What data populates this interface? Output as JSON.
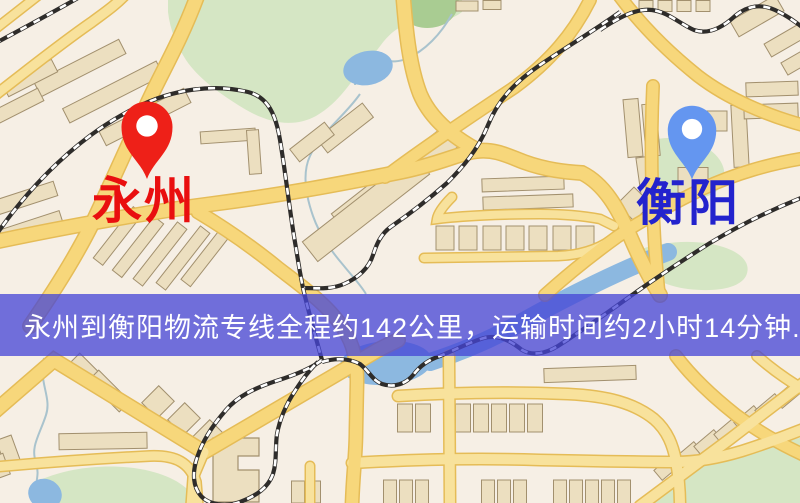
{
  "banner": {
    "text": "永州到衡阳物流专线全程约142公里，运输时间约2小时14分钟.",
    "bg": "rgba(70,70,214,0.76)",
    "text_color": "#ffffff",
    "top": 294,
    "height": 62
  },
  "route": {
    "from_city": "永州",
    "to_city": "衡阳",
    "distance_text": "约142公里",
    "duration_text": "约2小时14分钟"
  },
  "markers": [
    {
      "name": "yongzhou",
      "label": "永州",
      "pin_color": "#ee2018",
      "label_color": "#e90f0f",
      "x": 147,
      "y": 128,
      "scale": 1.02,
      "label_x": 92,
      "label_y": 176
    },
    {
      "name": "hengyang",
      "label": "衡阳",
      "pin_color": "#6496f0",
      "label_color": "#2323cd",
      "x": 692,
      "y": 131,
      "scale": 0.97,
      "label_x": 636,
      "label_y": 178
    }
  ],
  "map": {
    "bg": "#f6efe5",
    "palette": {
      "green": "#d5e6c4",
      "green_dark": "#a9cc92",
      "water": "#8cb8e0",
      "stream": "#a9c3cd",
      "building": "#ecdfc0",
      "building_line": "#a2906e",
      "road_casing": "#e5bc57",
      "road_fill": "#f7d77b",
      "road_minor": "#f8e29c",
      "rail_dark": "#2e2c2a"
    },
    "greens": [
      "M168,-6 L462,-6 L462,12 C444,26 428,18 408,24 C388,30 380,48 366,64 C350,82 340,102 316,116 C292,129 266,122 243,108 C220,94 198,78 186,60 C177,46 170,30 168,12 Z",
      "M646,142 C668,134 694,138 710,150 C726,162 728,177 719,189 C708,200 688,201 670,195 C653,189 644,176 644,161 Z",
      "M633,252 C658,242 690,239 716,245 C741,251 752,263 746,276 C739,289 714,292 688,289 C663,286 643,274 633,262 Z",
      "M40,480 C68,468 102,464 134,468 C163,472 182,482 192,494 L194,506 L36,506 Z",
      "M636,506 C658,486 688,468 720,460 C752,452 778,444 806,436 L806,506 Z"
    ],
    "park_pond": "M404,-6 L458,-6 C460,4 458,14 448,22 C436,30 418,30 408,22 C402,16 402,6 404,-6 Z",
    "streams": [
      "M452,14 C441,34 425,51 406,59 C391,65 379,57 367,63 C359,68 355,77 355,85",
      "M360,94 C344,117 320,133 310,156 C302,173 306,196 313,216 C320,236 332,252 344,266 C352,276 360,284 366,294",
      "M44,358 C38,382 52,397 46,415 C40,434 30,447 36,462 C40,475 35,484 35,494"
    ],
    "river": "M668,252 C625,268 568,296 522,322 C492,339 458,353 430,362",
    "waters": [
      {
        "cx": 368,
        "cy": 68,
        "rx": 25,
        "ry": 17,
        "r": -12
      },
      {
        "cx": 386,
        "cy": 363,
        "rx": 46,
        "ry": 22,
        "r": -4
      },
      {
        "cx": 45,
        "cy": 494,
        "rx": 17,
        "ry": 15,
        "r": 20
      }
    ],
    "roads": [
      {
        "d": "M198,-6 C182,38 162,72 149,100 C132,136 112,182 92,224 C72,264 48,300 30,326",
        "w": 13
      },
      {
        "d": "M-6,412 L54,360 L204,452 L378,350 L398,340",
        "w": 13
      },
      {
        "d": "M204,452 L193,478 L191,506",
        "w": 9,
        "minor": true
      },
      {
        "d": "M-6,242 C70,226 150,212 212,204 C282,195 340,184 400,172 C440,164 462,152 477,151 C496,149 508,156 524,162 C546,170 566,172 582,173 C604,184 618,208 630,236 C642,264 652,282 660,295",
        "w": 13
      },
      {
        "d": "M403,-6 C406,34 410,68 420,94 C431,120 455,138 477,150",
        "w": 13
      },
      {
        "d": "M385,177 C422,149 470,117 515,87 C550,61 573,34 590,0",
        "w": 11
      },
      {
        "d": "M653,86 C651,130 651,180 654,230 C655,252 657,275 659,295",
        "w": 11
      },
      {
        "d": "M618,-6 C640,24 668,52 698,76 C728,99 768,116 806,126",
        "w": 11
      },
      {
        "d": "M-6,96 C28,70 60,44 92,22 C104,13 116,5 126,-6",
        "w": 9,
        "minor": true
      },
      {
        "d": "M-6,30 L40,-6",
        "w": 8,
        "minor": true
      },
      {
        "d": "M452,197 C443,206 438,213 437,219 C460,216 500,214 540,214 C566,214 584,216 600,219 L614,226",
        "w": 8,
        "minor": true
      },
      {
        "d": "M424,258 L558,256 C582,255 598,249 611,240",
        "w": 8,
        "minor": true
      },
      {
        "d": "M545,295 C566,276 592,255 617,237 C642,220 672,204 702,189 C734,174 772,163 806,158",
        "w": 11
      },
      {
        "d": "M676,356 C691,376 712,396 736,415 C760,433 786,447 806,456",
        "w": 11
      },
      {
        "d": "M757,356 C773,370 792,383 806,391",
        "w": 9,
        "minor": true
      },
      {
        "d": "M640,506 C670,484 700,461 730,439 C756,419 782,399 806,381",
        "w": 10,
        "minor": true
      },
      {
        "d": "M449,356 L450,506",
        "w": 10,
        "minor": true
      },
      {
        "d": "M398,396 C460,392 520,392 568,394 C608,396 634,403 654,419 C668,431 673,446 676,461 C679,478 680,492 680,506",
        "w": 10,
        "minor": true
      },
      {
        "d": "M352,463 C420,459 480,458 540,460 C590,461 640,462 676,462 C700,462 722,457 742,451 C764,444 786,436 806,428",
        "w": 10,
        "minor": true
      },
      {
        "d": "M198,212 C228,230 256,250 278,268 C300,285 330,306 344,330 C354,345 357,362 357,382 L356,430 C356,456 353,472 352,506",
        "w": 12
      },
      {
        "d": "M310,466 L310,506",
        "w": 8,
        "minor": true
      },
      {
        "d": "M-6,467 C50,462 110,458 150,456 C176,455 190,463 196,482 L198,506",
        "w": 9,
        "minor": true
      }
    ],
    "rails": [
      "M-6,44 C20,30 50,14 85,-6",
      "M-6,238 C30,185 80,135 135,108 C175,88 215,84 248,92 C268,97 276,115 280,140 C286,175 290,215 296,248 C299,268 301,278 303,288",
      "M620,12 C595,30 565,48 540,65 C515,82 498,100 488,125 C478,150 462,168 447,183 C430,198 408,215 392,226 C380,234 376,246 373,255 C369,268 358,278 344,284 C330,290 315,288 304,288",
      "M303,288 C308,310 315,335 322,360",
      "M322,360 C312,368 295,375 276,381 C255,388 238,396 226,410 C212,426 202,442 197,458 C192,473 193,487 201,496 C209,505 226,507 240,502 C256,496 268,488 273,474 C277,461 275,448 277,434 C280,418 287,403 295,391 C302,380 310,369 318,362",
      "M322,362 C335,358 348,358 360,364 C370,372 372,380 382,384 C394,388 406,384 414,374 C420,366 428,360 440,356 C455,350 470,342 484,338 C500,334 512,342 522,350 C532,356 545,354 558,346 C575,335 600,318 625,300 C650,282 680,262 710,243 C740,225 770,210 806,196",
      "M600,30 C618,18 636,8 652,10 C668,12 680,24 694,30 C708,35 722,28 735,16 C748,5 762,4 775,10 C788,16 798,24 806,30"
    ],
    "buildings": [
      {
        "cx": 80,
        "cy": 68,
        "w": 95,
        "h": 16,
        "r": -27
      },
      {
        "cx": 113,
        "cy": 92,
        "w": 105,
        "h": 16,
        "r": -27
      },
      {
        "cx": 145,
        "cy": 117,
        "w": 95,
        "h": 16,
        "r": -27
      },
      {
        "cx": 30,
        "cy": 78,
        "w": 55,
        "h": 14,
        "r": -27
      },
      {
        "cx": 14,
        "cy": 108,
        "w": 60,
        "h": 14,
        "r": -27
      },
      {
        "cx": 26,
        "cy": 198,
        "w": 62,
        "h": 15,
        "r": -18
      },
      {
        "cx": 30,
        "cy": 228,
        "w": 66,
        "h": 15,
        "r": -18
      },
      {
        "cx": 228,
        "cy": 136,
        "w": 55,
        "h": 12,
        "r": -4
      },
      {
        "cx": 254,
        "cy": 152,
        "w": 12,
        "h": 44,
        "r": -4
      },
      {
        "cx": 118,
        "cy": 236,
        "w": 65,
        "h": 12,
        "r": -52
      },
      {
        "cx": 138,
        "cy": 247,
        "w": 68,
        "h": 12,
        "r": -52
      },
      {
        "cx": 160,
        "cy": 254,
        "w": 72,
        "h": 12,
        "r": -52
      },
      {
        "cx": 183,
        "cy": 258,
        "w": 72,
        "h": 12,
        "r": -52
      },
      {
        "cx": 206,
        "cy": 257,
        "w": 66,
        "h": 12,
        "r": -52
      },
      {
        "cx": 395,
        "cy": 180,
        "w": 142,
        "h": 25,
        "r": -38
      },
      {
        "cx": 366,
        "cy": 208,
        "w": 142,
        "h": 25,
        "r": -38
      },
      {
        "cx": 345,
        "cy": 128,
        "w": 58,
        "h": 18,
        "r": -38
      },
      {
        "cx": 312,
        "cy": 142,
        "w": 44,
        "h": 16,
        "r": -38
      },
      {
        "cx": 523,
        "cy": 184,
        "w": 82,
        "h": 13,
        "r": -2
      },
      {
        "cx": 528,
        "cy": 202,
        "w": 90,
        "h": 13,
        "r": -2
      },
      {
        "cx": 445,
        "cy": 238,
        "w": 18,
        "h": 24,
        "r": 0
      },
      {
        "cx": 468,
        "cy": 238,
        "w": 18,
        "h": 24,
        "r": 0
      },
      {
        "cx": 492,
        "cy": 238,
        "w": 18,
        "h": 24,
        "r": 0
      },
      {
        "cx": 515,
        "cy": 238,
        "w": 18,
        "h": 24,
        "r": 0
      },
      {
        "cx": 538,
        "cy": 238,
        "w": 18,
        "h": 24,
        "r": 0
      },
      {
        "cx": 562,
        "cy": 238,
        "w": 18,
        "h": 24,
        "r": 0
      },
      {
        "cx": 585,
        "cy": 238,
        "w": 18,
        "h": 24,
        "r": 0
      },
      {
        "cx": 633,
        "cy": 128,
        "w": 15,
        "h": 58,
        "r": -5
      },
      {
        "cx": 651,
        "cy": 130,
        "w": 14,
        "h": 52,
        "r": -5
      },
      {
        "cx": 716,
        "cy": 121,
        "w": 22,
        "h": 20,
        "r": 0
      },
      {
        "cx": 693,
        "cy": 180,
        "w": 30,
        "h": 25,
        "r": 0
      },
      {
        "cx": 740,
        "cy": 136,
        "w": 15,
        "h": 62,
        "r": -3
      },
      {
        "cx": 645,
        "cy": 176,
        "w": 13,
        "h": 38,
        "r": -8
      },
      {
        "cx": 634,
        "cy": 204,
        "w": 24,
        "h": 24,
        "r": 45
      },
      {
        "cx": 772,
        "cy": 89,
        "w": 52,
        "h": 14,
        "r": -2
      },
      {
        "cx": 771,
        "cy": 111,
        "w": 54,
        "h": 14,
        "r": -2
      },
      {
        "cx": 646,
        "cy": 6,
        "w": 14,
        "h": 11,
        "r": 0
      },
      {
        "cx": 665,
        "cy": 6,
        "w": 14,
        "h": 11,
        "r": 0
      },
      {
        "cx": 684,
        "cy": 6,
        "w": 14,
        "h": 11,
        "r": 0
      },
      {
        "cx": 703,
        "cy": 6,
        "w": 14,
        "h": 11,
        "r": 0
      },
      {
        "cx": 757,
        "cy": 16,
        "w": 52,
        "h": 18,
        "r": -30
      },
      {
        "cx": 786,
        "cy": 40,
        "w": 42,
        "h": 15,
        "r": -30
      },
      {
        "cx": 800,
        "cy": 60,
        "w": 36,
        "h": 14,
        "r": -30
      },
      {
        "cx": 467,
        "cy": 6,
        "w": 22,
        "h": 10,
        "r": 0
      },
      {
        "cx": 492,
        "cy": 5,
        "w": 18,
        "h": 9,
        "r": 0
      },
      {
        "cx": 90,
        "cy": 374,
        "w": 44,
        "h": 15,
        "r": 45
      },
      {
        "cx": 109,
        "cy": 391,
        "w": 44,
        "h": 15,
        "r": 45
      },
      {
        "cx": 158,
        "cy": 402,
        "w": 22,
        "h": 24,
        "r": 45
      },
      {
        "cx": 184,
        "cy": 419,
        "w": 22,
        "h": 24,
        "r": 45
      },
      {
        "cx": 209,
        "cy": 436,
        "w": 22,
        "h": 24,
        "r": 45
      },
      {
        "cx": 103,
        "cy": 441,
        "w": 88,
        "h": 16,
        "r": -1
      },
      {
        "cx": 8,
        "cy": 450,
        "w": 16,
        "h": 26,
        "r": -20
      },
      {
        "cx": 0,
        "cy": 466,
        "w": 14,
        "h": 22,
        "r": -20
      },
      {
        "cx": 405,
        "cy": 418,
        "w": 15,
        "h": 28,
        "r": 0
      },
      {
        "cx": 423,
        "cy": 418,
        "w": 15,
        "h": 28,
        "r": 0
      },
      {
        "cx": 463,
        "cy": 418,
        "w": 15,
        "h": 28,
        "r": 0
      },
      {
        "cx": 481,
        "cy": 418,
        "w": 15,
        "h": 28,
        "r": 0
      },
      {
        "cx": 499,
        "cy": 418,
        "w": 15,
        "h": 28,
        "r": 0
      },
      {
        "cx": 517,
        "cy": 418,
        "w": 15,
        "h": 28,
        "r": 0
      },
      {
        "cx": 535,
        "cy": 418,
        "w": 15,
        "h": 28,
        "r": 0
      },
      {
        "cx": 590,
        "cy": 374,
        "w": 92,
        "h": 14,
        "r": -2
      },
      {
        "cx": 390,
        "cy": 492,
        "w": 13,
        "h": 24,
        "r": 0
      },
      {
        "cx": 406,
        "cy": 492,
        "w": 13,
        "h": 24,
        "r": 0
      },
      {
        "cx": 422,
        "cy": 492,
        "w": 13,
        "h": 24,
        "r": 0
      },
      {
        "cx": 488,
        "cy": 492,
        "w": 13,
        "h": 24,
        "r": 0
      },
      {
        "cx": 504,
        "cy": 492,
        "w": 13,
        "h": 24,
        "r": 0
      },
      {
        "cx": 520,
        "cy": 492,
        "w": 13,
        "h": 24,
        "r": 0
      },
      {
        "cx": 560,
        "cy": 492,
        "w": 13,
        "h": 24,
        "r": 0
      },
      {
        "cx": 576,
        "cy": 492,
        "w": 13,
        "h": 24,
        "r": 0
      },
      {
        "cx": 592,
        "cy": 492,
        "w": 13,
        "h": 24,
        "r": 0
      },
      {
        "cx": 608,
        "cy": 492,
        "w": 13,
        "h": 24,
        "r": 0
      },
      {
        "cx": 624,
        "cy": 492,
        "w": 13,
        "h": 24,
        "r": 0
      },
      {
        "cx": 298,
        "cy": 492,
        "w": 13,
        "h": 22,
        "r": 0
      },
      {
        "cx": 314,
        "cy": 492,
        "w": 13,
        "h": 22,
        "r": 0
      },
      {
        "cx": 668,
        "cy": 467,
        "w": 26,
        "h": 13,
        "r": -40
      },
      {
        "cx": 688,
        "cy": 455,
        "w": 26,
        "h": 13,
        "r": -40
      },
      {
        "cx": 708,
        "cy": 443,
        "w": 26,
        "h": 13,
        "r": -40
      },
      {
        "cx": 728,
        "cy": 431,
        "w": 26,
        "h": 13,
        "r": -40
      },
      {
        "cx": 748,
        "cy": 419,
        "w": 26,
        "h": 13,
        "r": -40
      },
      {
        "cx": 769,
        "cy": 407,
        "w": 26,
        "h": 13,
        "r": -40
      },
      {
        "cx": 788,
        "cy": 395,
        "w": 26,
        "h": 13,
        "r": -40
      }
    ],
    "building_polys": [
      "M213,438 L259,438 L259,456 L238,456 L238,470 L259,470 L259,502 L213,502 Z"
    ]
  }
}
